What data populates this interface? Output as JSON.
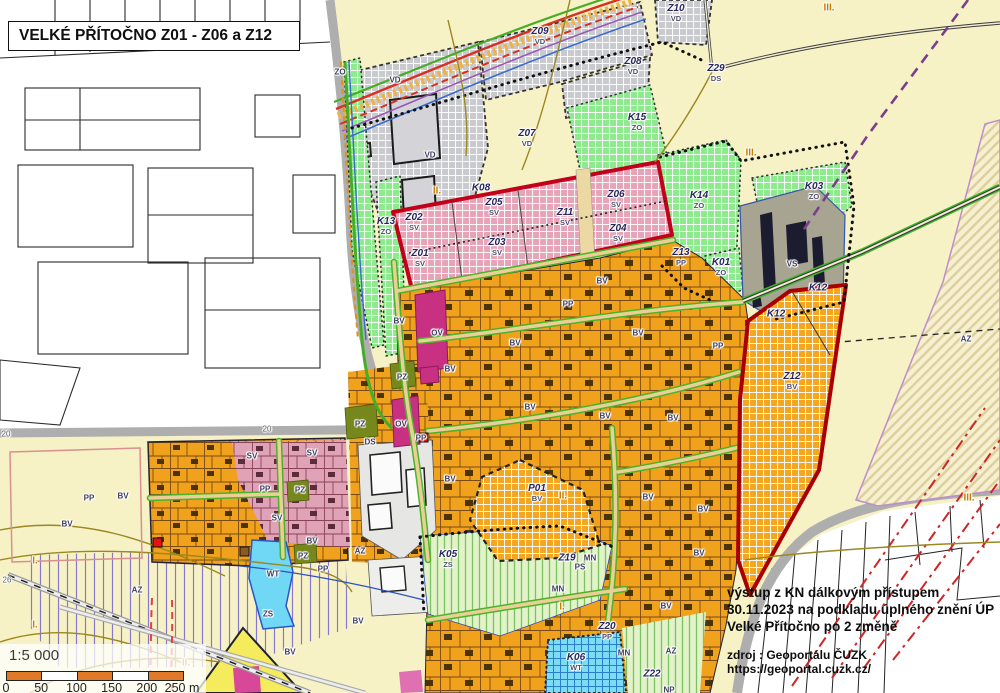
{
  "title": "VELKÉ PŘÍTOČNO Z01 - Z06 a Z12",
  "info_box": {
    "lines": [
      "výstup z KN dálkovým přístupem",
      "30.11.2023 na podkladu úplného znění ÚP",
      "Velké Přítočno po 2 změně"
    ],
    "source": "zdroj : Geoportálu ČUZK https://geoportal.cuzk.cz/"
  },
  "scale_box": {
    "ratio": "1:5 000",
    "bar_segments": [
      "#e07a28",
      "#ffffff",
      "#e07a28",
      "#ffffff",
      "#e07a28"
    ],
    "tick_labels": [
      "0",
      "50",
      "100",
      "150",
      "200",
      "250 m"
    ]
  },
  "legend_colors": {
    "village_housing_BV": "#f2a41c",
    "mixed_use_SV": "#e6a4b8",
    "production_VD": "#c9cacd",
    "greenery_ZO": "#8dea8d",
    "civic_OV": "#c83082",
    "public_green_PZ": "#76871c",
    "water_WT": "#70d8f4",
    "gardens_ZS": "#e2f3c8",
    "fields": "#f7f1c6",
    "change_area_outline": "#c2001a"
  },
  "map_labels": [
    {
      "type": "zone",
      "code": "Z10",
      "sub": "VD",
      "x": 676,
      "y": 13
    },
    {
      "type": "zone",
      "code": "Z09",
      "sub": "VD",
      "x": 540,
      "y": 36
    },
    {
      "type": "zone",
      "code": "Z08",
      "sub": "VD",
      "x": 633,
      "y": 66
    },
    {
      "type": "zone",
      "code": "K15",
      "sub": "ZO",
      "x": 637,
      "y": 122
    },
    {
      "type": "zone",
      "code": "Z07",
      "sub": "VD",
      "x": 527,
      "y": 138
    },
    {
      "type": "zone",
      "code": "Z29",
      "sub": "DS",
      "x": 716,
      "y": 73
    },
    {
      "type": "zone",
      "code": "K03",
      "sub": "ZO",
      "x": 814,
      "y": 191
    },
    {
      "type": "zone",
      "code": "K14",
      "sub": "ZO",
      "x": 699,
      "y": 200
    },
    {
      "type": "zone",
      "code": "K08",
      "x": 481,
      "y": 188
    },
    {
      "type": "zone",
      "code": "Z05",
      "sub": "SV",
      "x": 494,
      "y": 207
    },
    {
      "type": "zone",
      "code": "Z02",
      "sub": "SV",
      "x": 414,
      "y": 222
    },
    {
      "type": "zone",
      "code": "K13",
      "sub": "ZO",
      "x": 386,
      "y": 226
    },
    {
      "type": "zone",
      "code": "Z11",
      "sub": "SV",
      "x": 565,
      "y": 217
    },
    {
      "type": "zone",
      "code": "Z06",
      "sub": "SV",
      "x": 616,
      "y": 199
    },
    {
      "type": "zone",
      "code": "Z04",
      "sub": "SV",
      "x": 618,
      "y": 233
    },
    {
      "type": "zone",
      "code": "Z03",
      "sub": "SV",
      "x": 497,
      "y": 247
    },
    {
      "type": "zone",
      "code": "Z01",
      "sub": "SV",
      "x": 420,
      "y": 258
    },
    {
      "type": "zone",
      "code": "Z13",
      "sub": "PP",
      "x": 681,
      "y": 257
    },
    {
      "type": "zone",
      "code": "K01",
      "sub": "ZO",
      "x": 721,
      "y": 267
    },
    {
      "type": "zone",
      "code": "K12",
      "x": 818,
      "y": 288
    },
    {
      "type": "zone",
      "code": "K12",
      "x": 776,
      "y": 314
    },
    {
      "type": "zone",
      "code": "Z12",
      "sub": "BV",
      "x": 792,
      "y": 381
    },
    {
      "type": "zone",
      "code": "P01",
      "sub": "BV",
      "x": 537,
      "y": 493
    },
    {
      "type": "zone",
      "code": "K05",
      "sub": "ZS",
      "x": 448,
      "y": 559
    },
    {
      "type": "zone",
      "code": "Z19",
      "x": 567,
      "y": 558
    },
    {
      "type": "zone",
      "code": "Z20",
      "sub": "PP",
      "x": 607,
      "y": 631
    },
    {
      "type": "zone",
      "code": "K06",
      "sub": "WT",
      "x": 576,
      "y": 662
    },
    {
      "type": "zone",
      "code": "Z22",
      "x": 652,
      "y": 674
    },
    {
      "type": "use",
      "text": "VD",
      "x": 395,
      "y": 80
    },
    {
      "type": "use",
      "text": "VD",
      "x": 430,
      "y": 155
    },
    {
      "type": "use",
      "text": "ZO",
      "x": 340,
      "y": 72
    },
    {
      "type": "use",
      "text": "VS",
      "x": 792,
      "y": 264
    },
    {
      "type": "use",
      "text": "BV",
      "x": 399,
      "y": 321
    },
    {
      "type": "use",
      "text": "OV",
      "x": 437,
      "y": 333
    },
    {
      "type": "use",
      "text": "PZ",
      "x": 402,
      "y": 377
    },
    {
      "type": "use",
      "text": "BV",
      "x": 450,
      "y": 369
    },
    {
      "type": "use",
      "text": "PP",
      "x": 568,
      "y": 304
    },
    {
      "type": "use",
      "text": "BV",
      "x": 515,
      "y": 343
    },
    {
      "type": "use",
      "text": "BV",
      "x": 638,
      "y": 333
    },
    {
      "type": "use",
      "text": "PP",
      "x": 718,
      "y": 346
    },
    {
      "type": "use",
      "text": "BV",
      "x": 602,
      "y": 281
    },
    {
      "type": "use",
      "text": "BV",
      "x": 530,
      "y": 407
    },
    {
      "type": "use",
      "text": "BV",
      "x": 605,
      "y": 416
    },
    {
      "type": "use",
      "text": "BV",
      "x": 673,
      "y": 418
    },
    {
      "type": "use",
      "text": "PZ",
      "x": 360,
      "y": 424
    },
    {
      "type": "use",
      "text": "OV",
      "x": 401,
      "y": 424
    },
    {
      "type": "use",
      "text": "DS",
      "x": 370,
      "y": 442
    },
    {
      "type": "use",
      "text": "PP",
      "x": 421,
      "y": 438
    },
    {
      "type": "use",
      "text": "BV",
      "x": 450,
      "y": 479
    },
    {
      "type": "use",
      "text": "BV",
      "x": 648,
      "y": 497
    },
    {
      "type": "use",
      "text": "BV",
      "x": 703,
      "y": 509
    },
    {
      "type": "use",
      "text": "BV",
      "x": 699,
      "y": 553
    },
    {
      "type": "use",
      "text": "PP",
      "x": 89,
      "y": 498
    },
    {
      "type": "use",
      "text": "BV",
      "x": 123,
      "y": 496
    },
    {
      "type": "use",
      "text": "BV",
      "x": 67,
      "y": 524
    },
    {
      "type": "use",
      "text": "SV",
      "x": 252,
      "y": 456
    },
    {
      "type": "use",
      "text": "SV",
      "x": 312,
      "y": 453
    },
    {
      "type": "use",
      "text": "PP",
      "x": 265,
      "y": 489
    },
    {
      "type": "use",
      "text": "PZ",
      "x": 300,
      "y": 490
    },
    {
      "type": "use",
      "text": "SV",
      "x": 277,
      "y": 518
    },
    {
      "type": "use",
      "text": "BV",
      "x": 312,
      "y": 541
    },
    {
      "type": "use",
      "text": "PZ",
      "x": 303,
      "y": 556
    },
    {
      "type": "use",
      "text": "WT",
      "x": 273,
      "y": 574
    },
    {
      "type": "use",
      "text": "ZS",
      "x": 268,
      "y": 614
    },
    {
      "type": "use",
      "text": "BV",
      "x": 358,
      "y": 621
    },
    {
      "type": "use",
      "text": "BV",
      "x": 290,
      "y": 652
    },
    {
      "type": "use",
      "text": "PP",
      "x": 323,
      "y": 569
    },
    {
      "type": "use",
      "text": "AZ",
      "x": 360,
      "y": 551
    },
    {
      "type": "use",
      "text": "AZ",
      "x": 137,
      "y": 590
    },
    {
      "type": "use",
      "text": "AZ",
      "x": 966,
      "y": 339
    },
    {
      "type": "use",
      "text": "AZ",
      "x": 671,
      "y": 651
    },
    {
      "type": "use",
      "text": "MN",
      "x": 590,
      "y": 558
    },
    {
      "type": "use",
      "text": "PS",
      "x": 580,
      "y": 567
    },
    {
      "type": "use",
      "text": "MN",
      "x": 558,
      "y": 589
    },
    {
      "type": "use",
      "text": "MN",
      "x": 624,
      "y": 653
    },
    {
      "type": "use",
      "text": "NP",
      "x": 669,
      "y": 690
    },
    {
      "type": "use",
      "text": "BV",
      "x": 666,
      "y": 606
    },
    {
      "type": "roman",
      "text": "III.",
      "x": 829,
      "y": 8
    },
    {
      "type": "roman",
      "text": "III.",
      "x": 751,
      "y": 153
    },
    {
      "type": "roman",
      "text": "II.",
      "x": 437,
      "y": 191
    },
    {
      "type": "roman",
      "text": "II.",
      "x": 563,
      "y": 496
    },
    {
      "type": "roman",
      "text": "I.",
      "x": 562,
      "y": 607
    },
    {
      "type": "roman",
      "text": "II.",
      "x": 186,
      "y": 663
    },
    {
      "type": "roman",
      "text": "I.",
      "x": 35,
      "y": 561
    },
    {
      "type": "roman",
      "text": "I.",
      "x": 35,
      "y": 625
    },
    {
      "type": "roman",
      "text": "III.",
      "x": 969,
      "y": 498
    },
    {
      "type": "tiny",
      "text": "26",
      "x": 7,
      "y": 580
    },
    {
      "type": "tiny",
      "text": "20",
      "x": 6,
      "y": 434
    },
    {
      "type": "tiny",
      "text": "20",
      "x": 267,
      "y": 429
    }
  ]
}
